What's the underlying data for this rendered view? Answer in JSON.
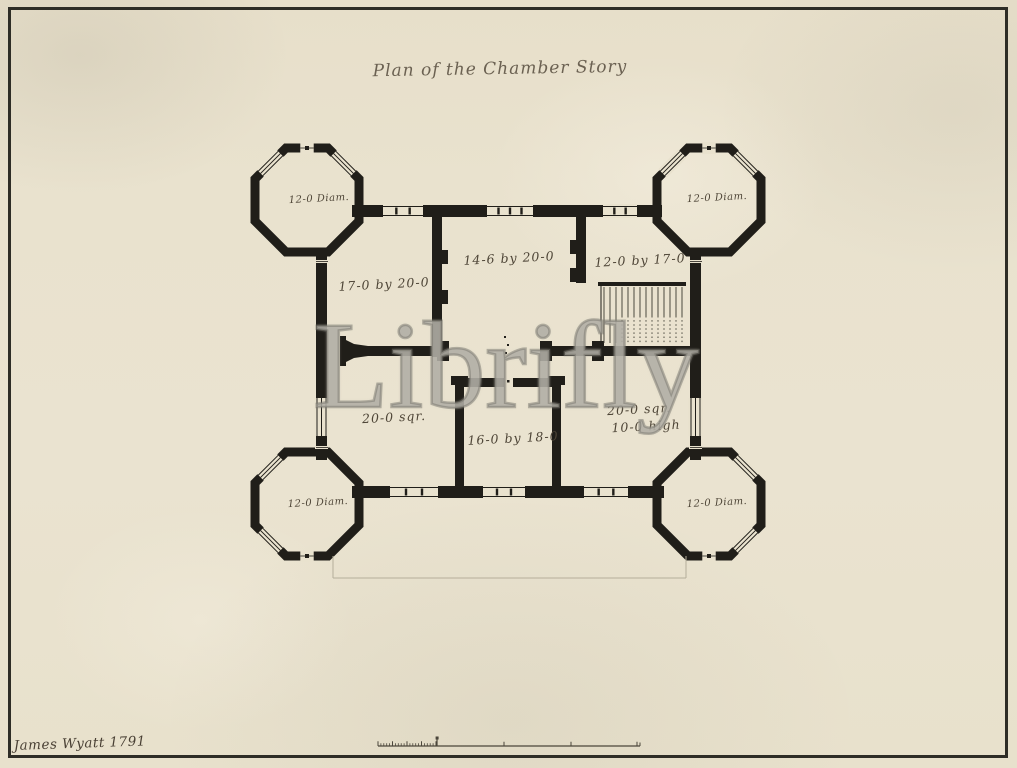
{
  "artwork": {
    "title": "Plan of the Chamber Story",
    "watermark": "Librifly",
    "signature": "James Wyatt 1791"
  },
  "plan": {
    "tower_labels": {
      "top_left": "12-0 Diam.",
      "top_right": "12-0 Diam.",
      "bottom_left": "12-0 Diam.",
      "bottom_right": "12-0 Diam."
    },
    "room_labels": {
      "northwest": "17-0 by 20-0",
      "north_center": "14-6 by 20-0",
      "northeast": "12-0 by 17-0",
      "southwest": "20-0 sqr.",
      "south_center": "16-0 by 18-0",
      "southeast_line1": "20-0 sqr.",
      "southeast_line2": "10-0 high"
    }
  }
}
